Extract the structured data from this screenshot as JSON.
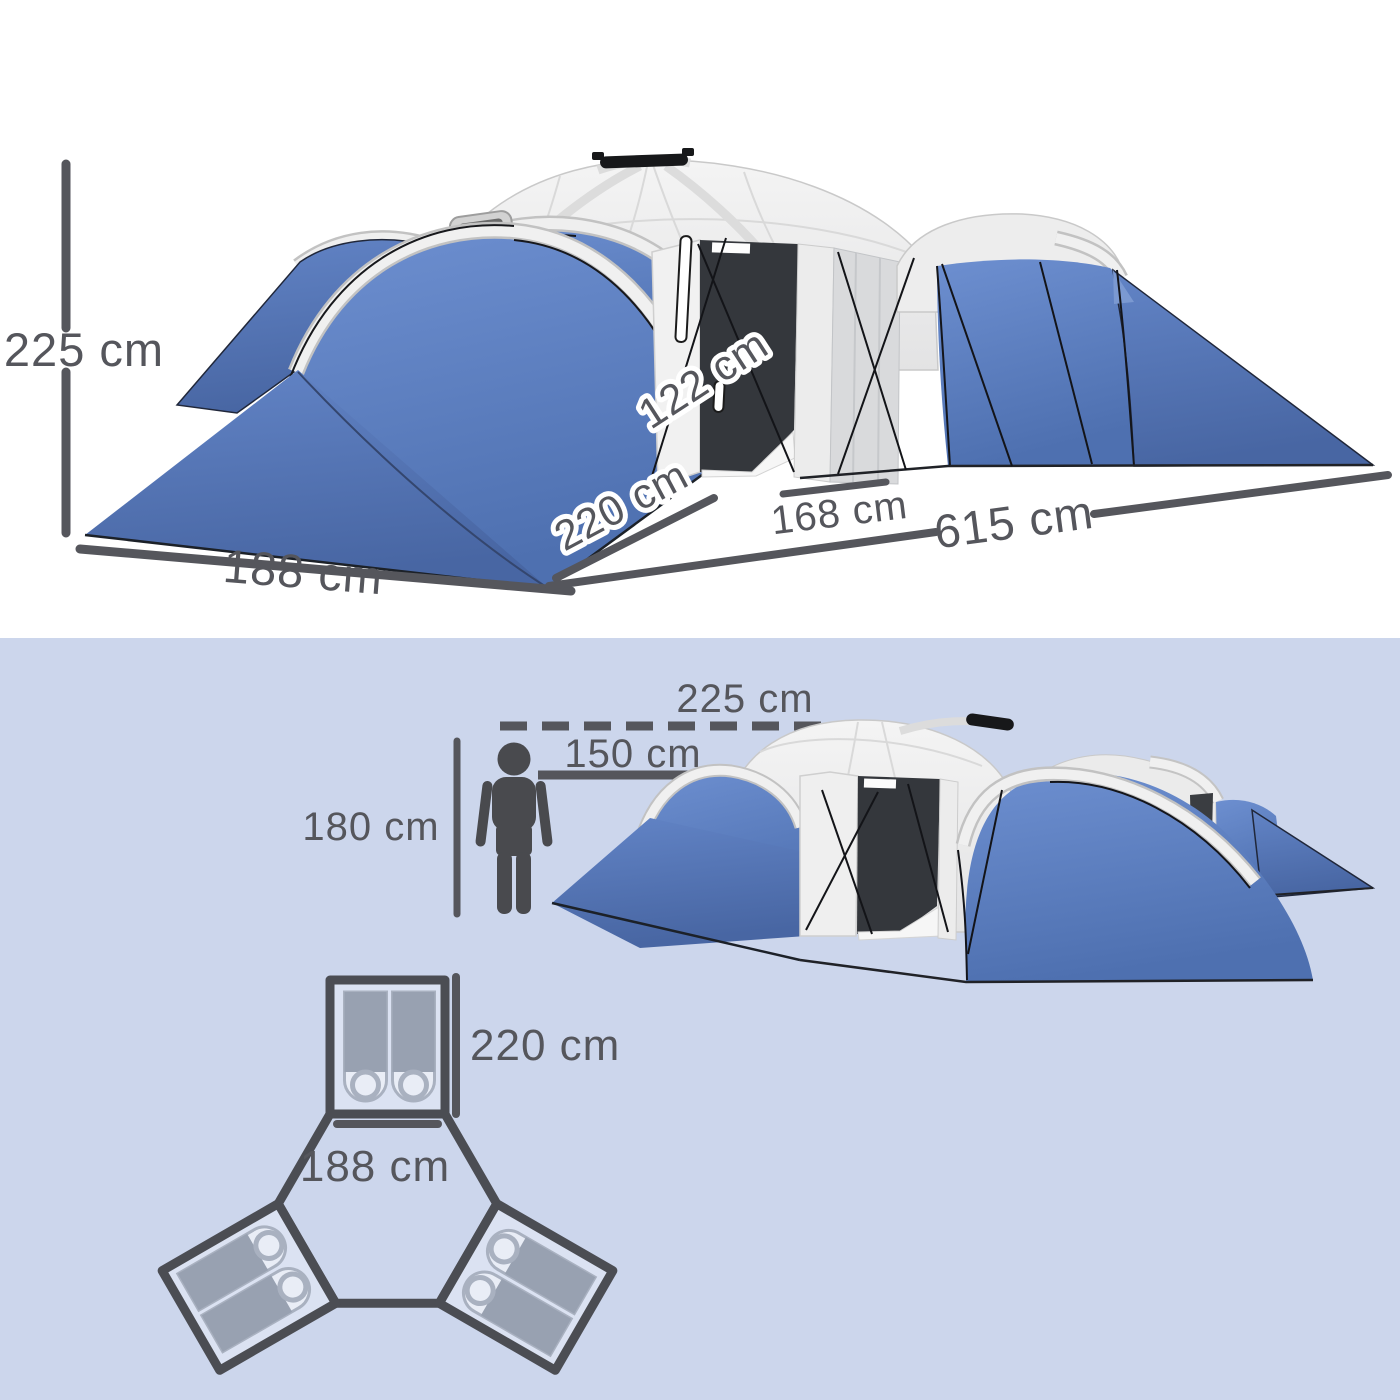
{
  "top_diagram": {
    "height": "225 cm",
    "door_height": "122 cm",
    "depth": "220 cm",
    "door_width": "168 cm",
    "length": "615 cm",
    "width": "188 cm"
  },
  "scale_view": {
    "peak_height": "225 cm",
    "inner_height": "150 cm",
    "person_height": "180 cm"
  },
  "floor_plan": {
    "room_depth": "220 cm",
    "room_width": "188 cm",
    "rooms": 3,
    "sleeping_bags_per_room": 2
  },
  "colors": {
    "tent_blue": "#5c80c3",
    "tent_blue_dark": "#4a6aa8",
    "canopy_white": "#ededed",
    "door_dark": "#35383d",
    "ink": "#55565c",
    "background_lower": "#ccd6ec",
    "plan_outline": "#4b4d53",
    "bag_gray": "#98a1b1",
    "bag_light": "#e9edf6",
    "room_fill": "#dbe2f2"
  }
}
